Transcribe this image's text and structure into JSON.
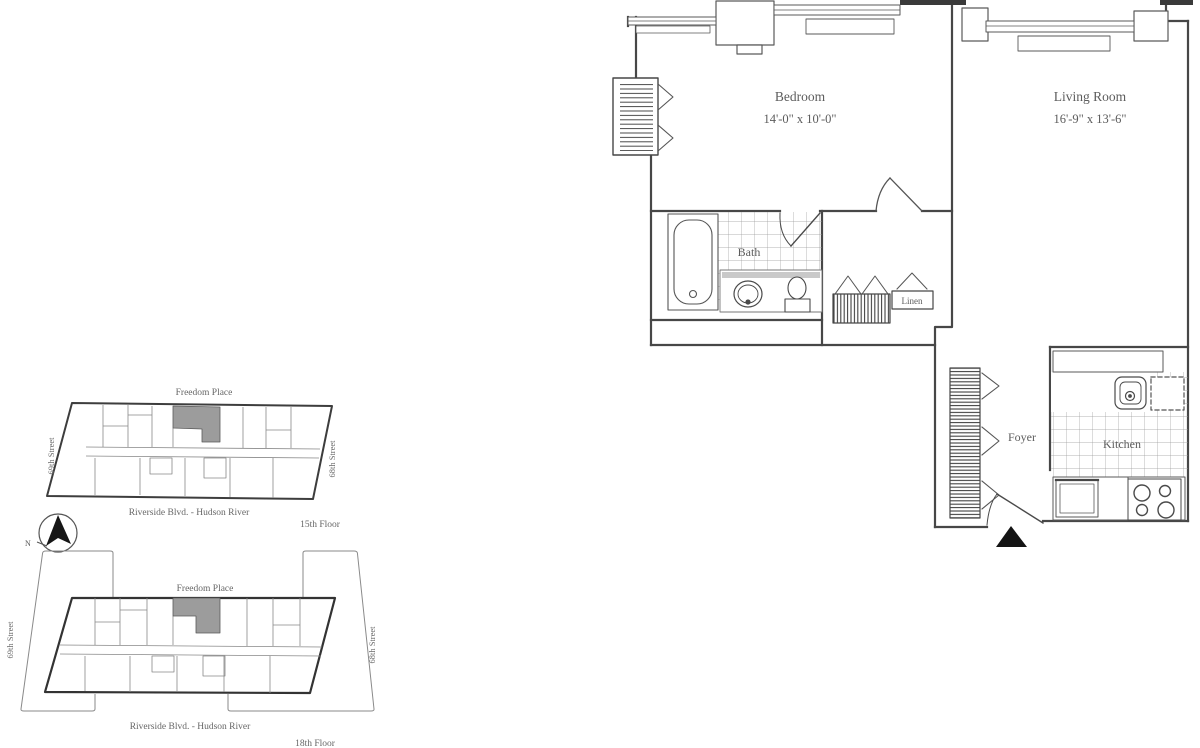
{
  "page": {
    "title": "One-bedroom apartment floor plan"
  },
  "floor_plan": {
    "rooms": {
      "bedroom": {
        "name": "Bedroom",
        "dims": "14'-0\" x 10'-0\""
      },
      "living_room": {
        "name": "Living Room",
        "dims": "16'-9\" x 13'-6\""
      },
      "bath": {
        "name": "Bath"
      },
      "linen": {
        "name": "Linen"
      },
      "foyer": {
        "name": "Foyer"
      },
      "kitchen": {
        "name": "Kitchen"
      }
    }
  },
  "key_plans": [
    {
      "floor": "15th Floor",
      "street_top": "Freedom Place",
      "street_bottom": "Riverside Blvd. - Hudson River",
      "street_left": "69th Street",
      "street_right": "68th Street"
    },
    {
      "floor": "18th Floor",
      "street_top": "Freedom Place",
      "street_bottom": "Riverside Blvd. - Hudson River",
      "street_left": "69th Street",
      "street_right": "68th Street"
    }
  ],
  "compass": {
    "north_label": "N"
  },
  "colors": {
    "wall": "#474747",
    "detail": "#6b6b6b",
    "tile_line": "#9a9a9a",
    "text": "#5c5c5c",
    "shaded_unit": "#9c9c9c",
    "entry_marker": "#141414",
    "background": "#ffffff"
  }
}
